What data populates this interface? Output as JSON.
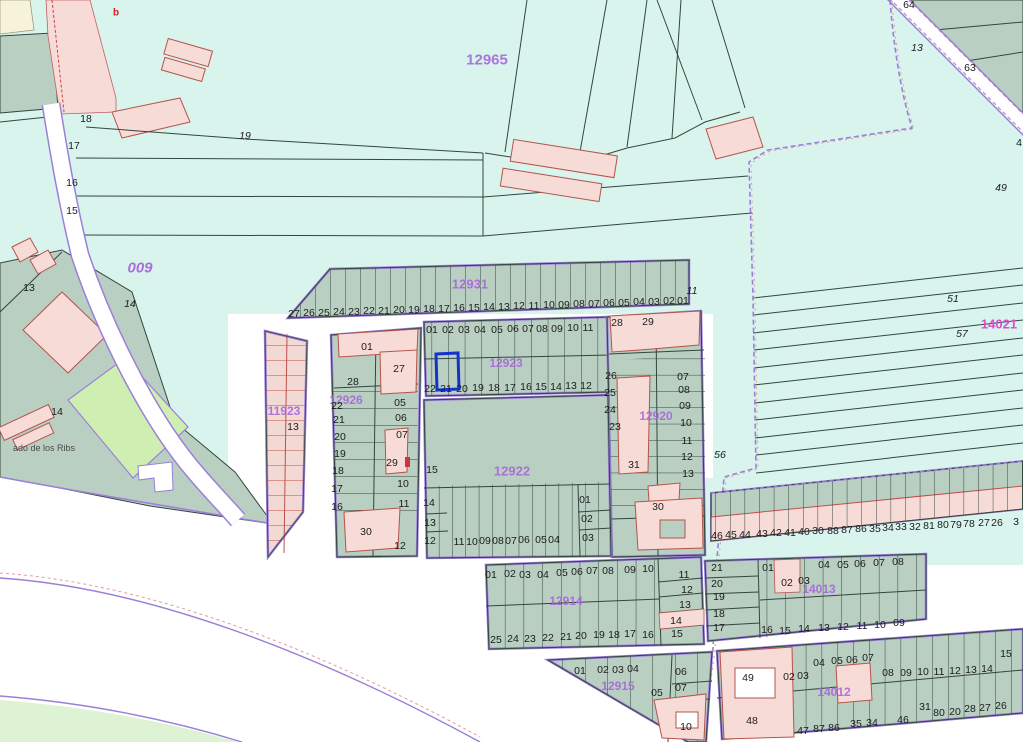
{
  "map": {
    "description": "Cadastral parcel map view with numbered parcels, urban blocks and one highlighted parcel",
    "colors": {
      "background": "#ffffff",
      "field_cyan": "#d8f4ec",
      "block_green_gray": "#b9cfc2",
      "building_pink": "#f7dbd7",
      "building_stroke": "#b5544c",
      "parcel_line": "#33463e",
      "road_edge_purple": "#9b7fd8",
      "boundary_dash_pink": "#e39a9a",
      "block_label_purple": "#a863dc",
      "magenta_label": "#d84fd0",
      "highlight_blue": "#1433cc",
      "green_parcel": "#cfeeb2",
      "green_area": "#ddf3d4",
      "cream_area": "#f7f3da"
    },
    "highlighted_parcel": {
      "block": "12923",
      "parcel": "21"
    },
    "block_ids": [
      "009",
      "11923",
      "12914",
      "12915",
      "12920",
      "12922",
      "12923",
      "12926",
      "12931",
      "12965",
      "14012",
      "14013",
      "14021"
    ],
    "labels": [
      {
        "t": "b",
        "x": 116,
        "y": 13,
        "c": "r"
      },
      {
        "t": "18",
        "x": 86,
        "y": 119
      },
      {
        "t": "17",
        "x": 74,
        "y": 146
      },
      {
        "t": "16",
        "x": 72,
        "y": 183
      },
      {
        "t": "15",
        "x": 72,
        "y": 211
      },
      {
        "t": "19",
        "x": 245,
        "y": 136,
        "c": "i"
      },
      {
        "t": "009",
        "x": 140,
        "y": 268,
        "c": "bi",
        "fs": 15
      },
      {
        "t": "13",
        "x": 29,
        "y": 288
      },
      {
        "t": "14",
        "x": 130,
        "y": 304,
        "c": "i"
      },
      {
        "t": "14",
        "x": 57,
        "y": 412
      },
      {
        "t": "ado de los Ribs",
        "x": 44,
        "y": 448,
        "c": "s"
      },
      {
        "t": "12965",
        "x": 487,
        "y": 60,
        "c": "b",
        "fs": 15
      },
      {
        "t": "64",
        "x": 909,
        "y": 5
      },
      {
        "t": "13",
        "x": 917,
        "y": 48,
        "c": "i"
      },
      {
        "t": "63",
        "x": 970,
        "y": 68
      },
      {
        "t": "4",
        "x": 1019,
        "y": 143
      },
      {
        "t": "49",
        "x": 1001,
        "y": 188,
        "c": "i"
      },
      {
        "t": "51",
        "x": 953,
        "y": 299,
        "c": "i"
      },
      {
        "t": "57",
        "x": 962,
        "y": 334,
        "c": "i"
      },
      {
        "t": "14021",
        "x": 999,
        "y": 324,
        "c": "m",
        "fs": 13
      },
      {
        "t": "56",
        "x": 720,
        "y": 455,
        "c": "i"
      },
      {
        "t": "11",
        "x": 692,
        "y": 291,
        "c": "i"
      },
      {
        "t": "12931",
        "x": 470,
        "y": 284,
        "c": "b",
        "fs": 13
      },
      {
        "t": "27",
        "x": 294,
        "y": 314
      },
      {
        "t": "26",
        "x": 309,
        "y": 313
      },
      {
        "t": "25",
        "x": 324,
        "y": 313
      },
      {
        "t": "24",
        "x": 339,
        "y": 312
      },
      {
        "t": "23",
        "x": 354,
        "y": 312
      },
      {
        "t": "22",
        "x": 369,
        "y": 311
      },
      {
        "t": "21",
        "x": 384,
        "y": 311
      },
      {
        "t": "20",
        "x": 399,
        "y": 310
      },
      {
        "t": "19",
        "x": 414,
        "y": 310
      },
      {
        "t": "18",
        "x": 429,
        "y": 309
      },
      {
        "t": "17",
        "x": 444,
        "y": 309
      },
      {
        "t": "16",
        "x": 459,
        "y": 308
      },
      {
        "t": "15",
        "x": 474,
        "y": 308
      },
      {
        "t": "14",
        "x": 489,
        "y": 307
      },
      {
        "t": "13",
        "x": 504,
        "y": 307
      },
      {
        "t": "12",
        "x": 519,
        "y": 306
      },
      {
        "t": "11",
        "x": 534,
        "y": 306
      },
      {
        "t": "10",
        "x": 549,
        "y": 305
      },
      {
        "t": "09",
        "x": 564,
        "y": 305
      },
      {
        "t": "08",
        "x": 579,
        "y": 304
      },
      {
        "t": "07",
        "x": 594,
        "y": 304
      },
      {
        "t": "06",
        "x": 609,
        "y": 303
      },
      {
        "t": "05",
        "x": 624,
        "y": 303
      },
      {
        "t": "04",
        "x": 639,
        "y": 302
      },
      {
        "t": "03",
        "x": 654,
        "y": 302
      },
      {
        "t": "02",
        "x": 669,
        "y": 301
      },
      {
        "t": "01",
        "x": 683,
        "y": 301
      },
      {
        "t": "12923",
        "x": 506,
        "y": 363,
        "c": "b",
        "fs": 12
      },
      {
        "t": "01",
        "x": 432,
        "y": 330
      },
      {
        "t": "02",
        "x": 448,
        "y": 330
      },
      {
        "t": "03",
        "x": 464,
        "y": 330
      },
      {
        "t": "04",
        "x": 480,
        "y": 330
      },
      {
        "t": "05",
        "x": 497,
        "y": 330
      },
      {
        "t": "06",
        "x": 513,
        "y": 329
      },
      {
        "t": "07",
        "x": 528,
        "y": 329
      },
      {
        "t": "08",
        "x": 542,
        "y": 329
      },
      {
        "t": "09",
        "x": 557,
        "y": 329
      },
      {
        "t": "10",
        "x": 573,
        "y": 328
      },
      {
        "t": "11",
        "x": 588,
        "y": 328
      },
      {
        "t": "22",
        "x": 430,
        "y": 389
      },
      {
        "t": "21",
        "x": 446,
        "y": 389
      },
      {
        "t": "20",
        "x": 462,
        "y": 389
      },
      {
        "t": "19",
        "x": 478,
        "y": 388
      },
      {
        "t": "18",
        "x": 494,
        "y": 388
      },
      {
        "t": "17",
        "x": 510,
        "y": 388
      },
      {
        "t": "16",
        "x": 526,
        "y": 387
      },
      {
        "t": "15",
        "x": 541,
        "y": 387
      },
      {
        "t": "14",
        "x": 556,
        "y": 387
      },
      {
        "t": "13",
        "x": 571,
        "y": 386
      },
      {
        "t": "12",
        "x": 586,
        "y": 386
      },
      {
        "t": "12926",
        "x": 346,
        "y": 400,
        "c": "b",
        "fs": 12
      },
      {
        "t": "01",
        "x": 367,
        "y": 347
      },
      {
        "t": "27",
        "x": 399,
        "y": 369
      },
      {
        "t": "28",
        "x": 353,
        "y": 382
      },
      {
        "t": "22",
        "x": 337,
        "y": 406
      },
      {
        "t": "05",
        "x": 400,
        "y": 403
      },
      {
        "t": "21",
        "x": 339,
        "y": 420
      },
      {
        "t": "06",
        "x": 401,
        "y": 418
      },
      {
        "t": "20",
        "x": 340,
        "y": 437
      },
      {
        "t": "07",
        "x": 402,
        "y": 435
      },
      {
        "t": "19",
        "x": 340,
        "y": 454
      },
      {
        "t": "29",
        "x": 392,
        "y": 463
      },
      {
        "t": "18",
        "x": 338,
        "y": 471
      },
      {
        "t": "10",
        "x": 403,
        "y": 484
      },
      {
        "t": "17",
        "x": 337,
        "y": 489
      },
      {
        "t": "16",
        "x": 337,
        "y": 507
      },
      {
        "t": "11",
        "x": 404,
        "y": 504
      },
      {
        "t": "30",
        "x": 366,
        "y": 532
      },
      {
        "t": "12",
        "x": 400,
        "y": 546
      },
      {
        "t": "11923",
        "x": 284,
        "y": 411,
        "c": "b",
        "fs": 12
      },
      {
        "t": "13",
        "x": 293,
        "y": 427
      },
      {
        "t": "12920",
        "x": 656,
        "y": 416,
        "c": "b",
        "fs": 12
      },
      {
        "t": "28",
        "x": 617,
        "y": 323
      },
      {
        "t": "29",
        "x": 648,
        "y": 322
      },
      {
        "t": "26",
        "x": 611,
        "y": 376
      },
      {
        "t": "25",
        "x": 610,
        "y": 393
      },
      {
        "t": "24",
        "x": 610,
        "y": 410
      },
      {
        "t": "23",
        "x": 615,
        "y": 427
      },
      {
        "t": "07",
        "x": 683,
        "y": 377
      },
      {
        "t": "08",
        "x": 684,
        "y": 390
      },
      {
        "t": "09",
        "x": 685,
        "y": 406
      },
      {
        "t": "10",
        "x": 686,
        "y": 423
      },
      {
        "t": "11",
        "x": 687,
        "y": 441
      },
      {
        "t": "12",
        "x": 687,
        "y": 457
      },
      {
        "t": "13",
        "x": 688,
        "y": 474
      },
      {
        "t": "31",
        "x": 634,
        "y": 465
      },
      {
        "t": "30",
        "x": 658,
        "y": 507
      },
      {
        "t": "12922",
        "x": 512,
        "y": 471,
        "c": "b",
        "fs": 13
      },
      {
        "t": "15",
        "x": 432,
        "y": 470
      },
      {
        "t": "14",
        "x": 429,
        "y": 503
      },
      {
        "t": "13",
        "x": 430,
        "y": 523
      },
      {
        "t": "12",
        "x": 430,
        "y": 541
      },
      {
        "t": "01",
        "x": 585,
        "y": 500
      },
      {
        "t": "02",
        "x": 587,
        "y": 519
      },
      {
        "t": "03",
        "x": 588,
        "y": 538
      },
      {
        "t": "11",
        "x": 459,
        "y": 542
      },
      {
        "t": "10",
        "x": 472,
        "y": 542
      },
      {
        "t": "09",
        "x": 485,
        "y": 541
      },
      {
        "t": "08",
        "x": 498,
        "y": 541
      },
      {
        "t": "07",
        "x": 511,
        "y": 541
      },
      {
        "t": "06",
        "x": 524,
        "y": 540
      },
      {
        "t": "05",
        "x": 541,
        "y": 540
      },
      {
        "t": "04",
        "x": 554,
        "y": 540
      },
      {
        "t": "46",
        "x": 717,
        "y": 536
      },
      {
        "t": "45",
        "x": 731,
        "y": 535
      },
      {
        "t": "44",
        "x": 745,
        "y": 535
      },
      {
        "t": "43",
        "x": 762,
        "y": 534
      },
      {
        "t": "42",
        "x": 776,
        "y": 533
      },
      {
        "t": "41",
        "x": 790,
        "y": 533
      },
      {
        "t": "40",
        "x": 804,
        "y": 532
      },
      {
        "t": "30",
        "x": 818,
        "y": 531
      },
      {
        "t": "88",
        "x": 833,
        "y": 531
      },
      {
        "t": "87",
        "x": 847,
        "y": 530
      },
      {
        "t": "86",
        "x": 861,
        "y": 529
      },
      {
        "t": "35",
        "x": 875,
        "y": 529
      },
      {
        "t": "34",
        "x": 888,
        "y": 528
      },
      {
        "t": "33",
        "x": 901,
        "y": 527
      },
      {
        "t": "32",
        "x": 915,
        "y": 527
      },
      {
        "t": "81",
        "x": 929,
        "y": 526
      },
      {
        "t": "80",
        "x": 943,
        "y": 525
      },
      {
        "t": "79",
        "x": 956,
        "y": 525
      },
      {
        "t": "78",
        "x": 969,
        "y": 524
      },
      {
        "t": "27",
        "x": 984,
        "y": 523
      },
      {
        "t": "26",
        "x": 997,
        "y": 523
      },
      {
        "t": "3",
        "x": 1016,
        "y": 522
      },
      {
        "t": "12914",
        "x": 566,
        "y": 601,
        "c": "b",
        "fs": 12
      },
      {
        "t": "01",
        "x": 491,
        "y": 575
      },
      {
        "t": "02",
        "x": 510,
        "y": 574
      },
      {
        "t": "03",
        "x": 525,
        "y": 575
      },
      {
        "t": "04",
        "x": 543,
        "y": 575
      },
      {
        "t": "05",
        "x": 562,
        "y": 573
      },
      {
        "t": "06",
        "x": 577,
        "y": 572
      },
      {
        "t": "07",
        "x": 592,
        "y": 571
      },
      {
        "t": "08",
        "x": 608,
        "y": 571
      },
      {
        "t": "09",
        "x": 630,
        "y": 570
      },
      {
        "t": "10",
        "x": 648,
        "y": 569
      },
      {
        "t": "11",
        "x": 684,
        "y": 575
      },
      {
        "t": "12",
        "x": 687,
        "y": 590
      },
      {
        "t": "13",
        "x": 685,
        "y": 605
      },
      {
        "t": "14",
        "x": 676,
        "y": 621
      },
      {
        "t": "15",
        "x": 677,
        "y": 634
      },
      {
        "t": "25",
        "x": 496,
        "y": 640
      },
      {
        "t": "24",
        "x": 513,
        "y": 639
      },
      {
        "t": "23",
        "x": 530,
        "y": 639
      },
      {
        "t": "22",
        "x": 548,
        "y": 638
      },
      {
        "t": "21",
        "x": 566,
        "y": 637
      },
      {
        "t": "20",
        "x": 581,
        "y": 636
      },
      {
        "t": "19",
        "x": 599,
        "y": 635
      },
      {
        "t": "18",
        "x": 614,
        "y": 635
      },
      {
        "t": "17",
        "x": 630,
        "y": 634
      },
      {
        "t": "16",
        "x": 648,
        "y": 635
      },
      {
        "t": "14013",
        "x": 819,
        "y": 589,
        "c": "b",
        "fs": 12
      },
      {
        "t": "21",
        "x": 717,
        "y": 568
      },
      {
        "t": "20",
        "x": 717,
        "y": 584
      },
      {
        "t": "19",
        "x": 719,
        "y": 597
      },
      {
        "t": "18",
        "x": 719,
        "y": 614
      },
      {
        "t": "17",
        "x": 719,
        "y": 628
      },
      {
        "t": "01",
        "x": 768,
        "y": 568
      },
      {
        "t": "02",
        "x": 787,
        "y": 583
      },
      {
        "t": "03",
        "x": 804,
        "y": 581
      },
      {
        "t": "04",
        "x": 824,
        "y": 565
      },
      {
        "t": "05",
        "x": 843,
        "y": 565
      },
      {
        "t": "06",
        "x": 860,
        "y": 564
      },
      {
        "t": "07",
        "x": 879,
        "y": 563
      },
      {
        "t": "08",
        "x": 898,
        "y": 562
      },
      {
        "t": "16",
        "x": 767,
        "y": 630
      },
      {
        "t": "15",
        "x": 785,
        "y": 631
      },
      {
        "t": "14",
        "x": 804,
        "y": 629
      },
      {
        "t": "13",
        "x": 824,
        "y": 628
      },
      {
        "t": "12",
        "x": 843,
        "y": 627
      },
      {
        "t": "11",
        "x": 862,
        "y": 626
      },
      {
        "t": "10",
        "x": 880,
        "y": 625
      },
      {
        "t": "09",
        "x": 899,
        "y": 623
      },
      {
        "t": "12915",
        "x": 618,
        "y": 686,
        "c": "b",
        "fs": 12
      },
      {
        "t": "01",
        "x": 580,
        "y": 671
      },
      {
        "t": "02",
        "x": 603,
        "y": 670
      },
      {
        "t": "03",
        "x": 618,
        "y": 670
      },
      {
        "t": "04",
        "x": 633,
        "y": 669
      },
      {
        "t": "05",
        "x": 657,
        "y": 693
      },
      {
        "t": "06",
        "x": 681,
        "y": 672
      },
      {
        "t": "07",
        "x": 681,
        "y": 688
      },
      {
        "t": "10",
        "x": 686,
        "y": 727
      },
      {
        "t": "14012",
        "x": 834,
        "y": 692,
        "c": "b",
        "fs": 12
      },
      {
        "t": "49",
        "x": 748,
        "y": 678
      },
      {
        "t": "02",
        "x": 789,
        "y": 677
      },
      {
        "t": "03",
        "x": 803,
        "y": 676
      },
      {
        "t": "04",
        "x": 819,
        "y": 663
      },
      {
        "t": "05",
        "x": 837,
        "y": 661
      },
      {
        "t": "06",
        "x": 852,
        "y": 660
      },
      {
        "t": "07",
        "x": 868,
        "y": 658
      },
      {
        "t": "08",
        "x": 888,
        "y": 673
      },
      {
        "t": "09",
        "x": 906,
        "y": 673
      },
      {
        "t": "10",
        "x": 923,
        "y": 672
      },
      {
        "t": "11",
        "x": 939,
        "y": 672
      },
      {
        "t": "12",
        "x": 955,
        "y": 671
      },
      {
        "t": "13",
        "x": 971,
        "y": 670
      },
      {
        "t": "14",
        "x": 987,
        "y": 669
      },
      {
        "t": "15",
        "x": 1006,
        "y": 654
      },
      {
        "t": "48",
        "x": 752,
        "y": 721
      },
      {
        "t": "47",
        "x": 803,
        "y": 731
      },
      {
        "t": "87",
        "x": 819,
        "y": 729
      },
      {
        "t": "86",
        "x": 834,
        "y": 728
      },
      {
        "t": "35",
        "x": 856,
        "y": 724
      },
      {
        "t": "34",
        "x": 872,
        "y": 723
      },
      {
        "t": "46",
        "x": 903,
        "y": 720
      },
      {
        "t": "31",
        "x": 925,
        "y": 707
      },
      {
        "t": "80",
        "x": 939,
        "y": 713
      },
      {
        "t": "20",
        "x": 955,
        "y": 712
      },
      {
        "t": "28",
        "x": 970,
        "y": 709
      },
      {
        "t": "27",
        "x": 985,
        "y": 708
      },
      {
        "t": "26",
        "x": 1001,
        "y": 706
      }
    ]
  }
}
